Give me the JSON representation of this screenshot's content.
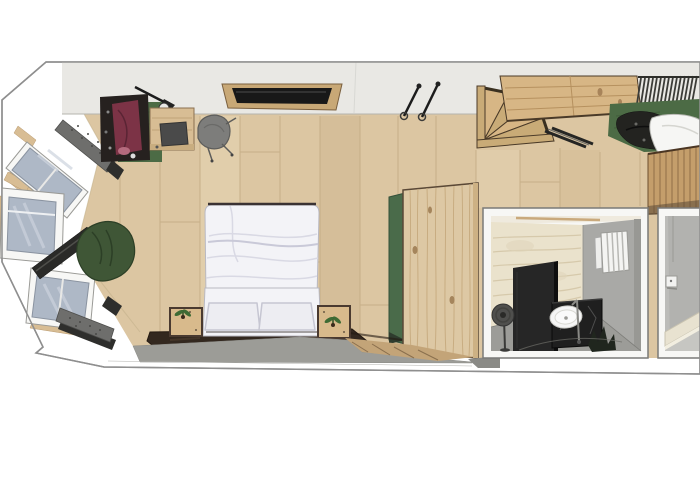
{
  "scene": {
    "alt": "3D top-down floor plan rendering of a studio bedroom: angled bay with three windows and window-seat benches, green beanbag, clothes rack, desk and chair, wall TV, trekking poles, winder staircase with wooden landing and slatted railing, gear on a green rug, wooden slat wall, tall pine wardrobe with green headboard panel, white double bed with two pillows and nightstands with plants on a dark rug, plus two inset interior views of the bathroom with travertine wall, black privacy panel, basin vanity, towel radiator, standing fan and a beige step."
  },
  "palette": {
    "page_bg": "#ffffff",
    "wall_band": "#ffffff",
    "wall_outline": "#8f8f8f",
    "interior_wall": "#e9e8e4",
    "interior_wall_edge": "#b5b4ae",
    "floor_wood": "#dcc6a2",
    "floor_seam": "#c3ab84",
    "window_glass": "#aeb8c6",
    "window_glass_streak": "#ccd3dd",
    "window_frame": "#f7f7f5",
    "sill_wood": "#d8bd94",
    "bench_cushion": "#6e6e6c",
    "bench_base": "#2e2e2c",
    "plank_dark": "#2a2a28",
    "beanbag_green": "#3f5636",
    "beanbag_line": "#2c3f26",
    "rug_green": "#4c6b45",
    "rug_green_line": "#3f5a39",
    "clothes_dark": "#26211f",
    "clothes_maroon": "#7c3346",
    "clothes_pink": "#b56b7e",
    "desk_wood": "#d8bd94",
    "laptop_gray": "#4a4a4a",
    "chair_gray": "#7d7d7b",
    "stair_wood": "#d7b685",
    "stair_wood_alt": "#c9ab77",
    "stair_edge": "#4a3a28",
    "railing_dark": "#3c3c38",
    "gear_dark": "#232320",
    "blanket_white": "#f6f6f4",
    "slat_wall": "#c49e6b",
    "slat_seam": "#916f47",
    "wardrobe_wood": "#ddc8a4",
    "wardrobe_grain": "#c6aa7e",
    "wardrobe_outline": "#5a4836",
    "headboard_green": "#4a6b4a",
    "bed_white": "#f3f3f7",
    "bed_fold": "#d9d9e4",
    "pillow_white": "#ededf2",
    "bed_outline": "#3a3233",
    "nightstand_wood": "#d8ba8c",
    "nightstand_frame": "#4a3a30",
    "plant_green": "#3e6b34",
    "rug_dark": "#33281f",
    "rug_dark_streak": "#4a3a2c",
    "floor_shadow": "#9c9c97",
    "wedge_wood": "#c3a478",
    "wedge_seam": "#8a6f4e",
    "tv_frame": "#c8a876",
    "tv_screen": "#181818",
    "pole_dark": "#1c1c1c",
    "bath_travertine": "#eae2cc",
    "bath_travertine_streak": "#d6c9ab",
    "bath_wall_gray": "#a9a9a6",
    "bath_wall_gray2": "#b2b2af",
    "bath_floor": "#9c9c98",
    "bath_floor_light": "#c6c6c2",
    "bath_panel_black": "#262626",
    "bath_vanity_black": "#1f1f1f",
    "sink_white": "#f5f5f5",
    "radiator_white": "#f4f4f2",
    "fan_gray": "#4f4f4d",
    "step_beige": "#e8e2d0",
    "inset_border": "#7a7a78",
    "ceiling_sliver": "#efeade"
  }
}
